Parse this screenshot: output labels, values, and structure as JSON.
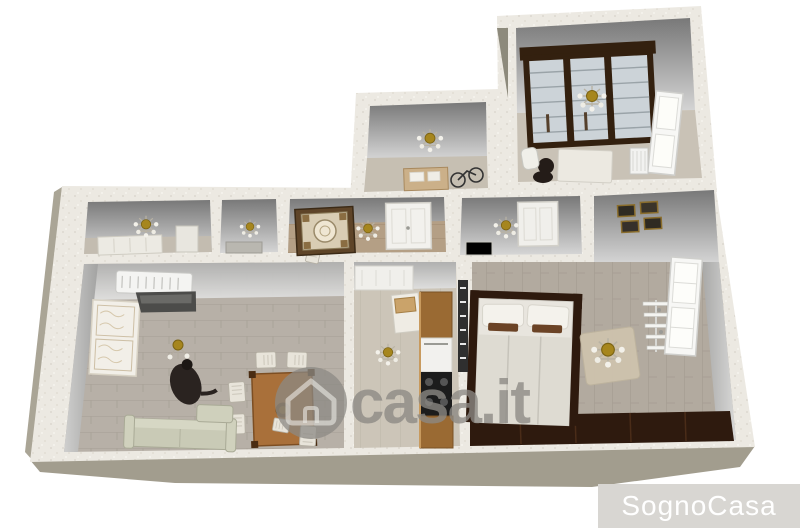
{
  "image": {
    "type": "3d-floor-plan-render",
    "description": "Top-down 3D rendering of an apartment floor plan with furnished rooms"
  },
  "watermarks": {
    "center_logo_text": "casa.it",
    "bottom_right_text": "SognoCasa"
  },
  "colors": {
    "background": "#ffffff",
    "outer_wall": "#ebe8e1",
    "slab_shadow": "#a29d8e",
    "inner_wall_dark": "#787878",
    "inner_wall_light": "#d6d6d6",
    "living_floor": "#b7b0a7",
    "bedroom_floor": "#b2aa9f",
    "kitchen_floor": "#ccc5b8",
    "hall_floor": "#b49f85",
    "dark_wood": "#33200f",
    "cabinet_wood": "#9a6a33",
    "table_wood": "#a9703a",
    "sofa_green": "#c9cab6",
    "chandelier_gold": "#a6861e",
    "watermark_gray": "rgba(140,137,132,0.78)",
    "brand_band_gray": "#d8d6d2"
  },
  "scene": {
    "rooms": [
      {
        "name": "studio-top-right",
        "furniture": [
          "glass-door-wardrobe",
          "chandelier",
          "window",
          "desk",
          "chair",
          "radiator"
        ]
      },
      {
        "name": "utility-top-center",
        "furniture": [
          "chandelier",
          "desk",
          "bike"
        ]
      },
      {
        "name": "bathroom-left",
        "furniture": [
          "chandelier",
          "white-cabinet",
          "shelf"
        ]
      },
      {
        "name": "closet",
        "furniture": [
          "chandelier",
          "counter"
        ]
      },
      {
        "name": "entry-hall",
        "furniture": [
          "ornate-rug",
          "chandelier",
          "door"
        ]
      },
      {
        "name": "bathroom-center",
        "furniture": [
          "chandelier",
          "door",
          "fixture"
        ]
      },
      {
        "name": "living-room",
        "furniture": [
          "air-conditioner",
          "decor-panel",
          "floor-lamp",
          "figure",
          "dining-table",
          "chairs",
          "sofa"
        ]
      },
      {
        "name": "kitchen",
        "furniture": [
          "upper-cabinets",
          "corner-counter",
          "fridge",
          "cooktop",
          "chandelier"
        ]
      },
      {
        "name": "master-bedroom",
        "furniture": [
          "double-bed",
          "pillows",
          "wardrobe-strip",
          "chandelier",
          "rug",
          "shelf-rack",
          "window",
          "wall-pictures",
          "radiator"
        ]
      }
    ]
  }
}
